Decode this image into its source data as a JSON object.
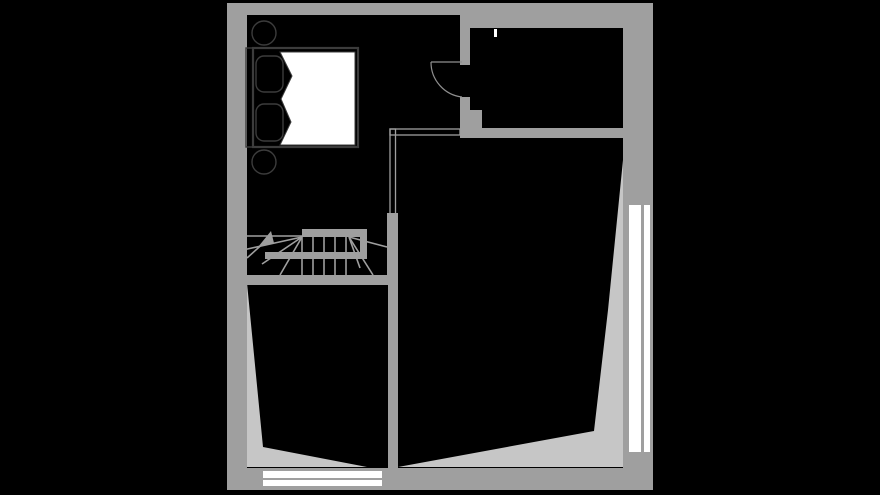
{
  "plan": {
    "kind": "architectural-floor-plan",
    "visible_text": [],
    "colors": {
      "background": "#000000",
      "wall": "#9f9f9f",
      "sloped_ceiling": "#c6c6c6",
      "window_glass": "#ffffff",
      "furniture_outline": "#3c3c3c",
      "duvet": "#ffffff",
      "door_swing": "#8f8f8f"
    },
    "elements": {
      "rooms": [
        {
          "id": "room-top-left",
          "floor": "black",
          "contents": [
            "double-bed",
            "two-pillows",
            "two-round-side-tables"
          ]
        },
        {
          "id": "room-top-right",
          "floor": "black",
          "contents": [
            "wall-marker"
          ]
        },
        {
          "id": "room-bottom-left",
          "floor": "black",
          "contents": [
            "sloped-ceiling-wedge"
          ]
        },
        {
          "id": "room-bottom-right",
          "floor": "black",
          "contents": [
            "sloped-ceiling-wedge"
          ]
        }
      ],
      "stairs": {
        "id": "winder-staircase",
        "direction_arrow": "up",
        "railing": "double-line"
      },
      "doors": [
        {
          "id": "interior-door",
          "swing": "quarter-arc"
        }
      ],
      "windows": [
        {
          "id": "window-bottom",
          "panes": 2
        },
        {
          "id": "window-right",
          "panes": 2
        },
        {
          "id": "wall-marker-top",
          "panes": 1
        }
      ]
    }
  }
}
